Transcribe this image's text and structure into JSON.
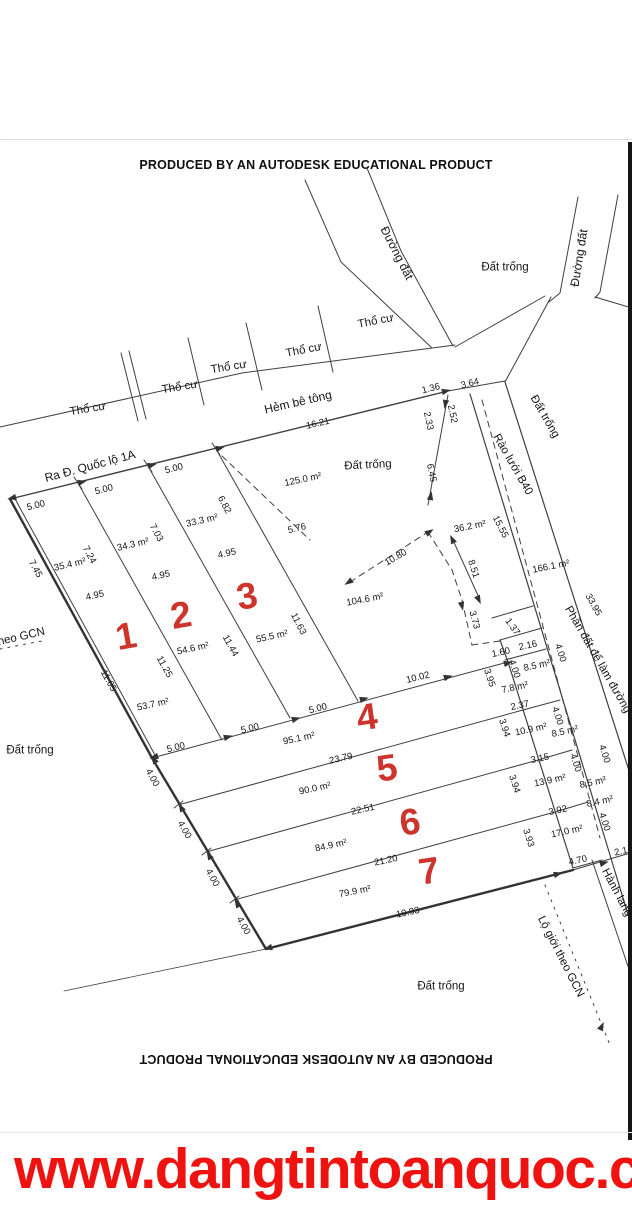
{
  "watermark": {
    "text": "PRODUCED BY AN AUTODESK EDUCATIONAL PRODUCT"
  },
  "footer": {
    "url": "www.dangtintoanquoc.co"
  },
  "colors": {
    "plot_number": "#c9251d",
    "url": "#ee1310",
    "line": "#3f3f3f"
  },
  "plots": [
    {
      "no": "1",
      "area": "53.7 m²"
    },
    {
      "no": "2",
      "area": "54.6 m²"
    },
    {
      "no": "3",
      "area": "55.5 m²"
    },
    {
      "no": "4",
      "area": "95.1 m²"
    },
    {
      "no": "5",
      "area": "90.0 m²"
    },
    {
      "no": "6",
      "area": "84.9 m²"
    },
    {
      "no": "7",
      "area": "79.9 m²"
    }
  ],
  "map": {
    "labels": [
      {
        "t": "Đường đất",
        "x": 397,
        "y": 253,
        "r": 63,
        "c": "r"
      },
      {
        "t": "Đường đất",
        "x": 579,
        "y": 258,
        "r": -81,
        "c": "r"
      },
      {
        "t": "Đất trống",
        "x": 505,
        "y": 268,
        "r": 0,
        "c": "p"
      },
      {
        "t": "Thổ cư",
        "x": 88,
        "y": 410,
        "r": -9,
        "c": "p"
      },
      {
        "t": "Thổ cư",
        "x": 180,
        "y": 388,
        "r": -9,
        "c": "p"
      },
      {
        "t": "Thổ cư",
        "x": 229,
        "y": 368,
        "r": -9,
        "c": "p"
      },
      {
        "t": "Thổ cư",
        "x": 304,
        "y": 351,
        "r": -11,
        "c": "p"
      },
      {
        "t": "Thổ cư",
        "x": 376,
        "y": 322,
        "r": -11,
        "c": "p"
      },
      {
        "t": "Hẻm bê tông",
        "x": 298,
        "y": 402,
        "r": -13,
        "c": "r"
      },
      {
        "t": "Ra Đ. Quốc lộ 1A",
        "x": 90,
        "y": 466,
        "r": -15,
        "c": "r"
      },
      {
        "t": "Đất trống",
        "x": 368,
        "y": 466,
        "r": -3,
        "c": "p"
      },
      {
        "t": "Đất trống",
        "x": 544,
        "y": 417,
        "r": 60,
        "c": "p"
      },
      {
        "t": "Rào lưới B40",
        "x": 512,
        "y": 465,
        "r": 60,
        "c": "p"
      },
      {
        "t": "Phần đất để làm đường",
        "x": 597,
        "y": 660,
        "r": 60,
        "c": "p"
      },
      {
        "t": "Hành lang",
        "x": 616,
        "y": 893,
        "r": 62,
        "c": "p"
      },
      {
        "t": "Lộ giới theo GCN",
        "x": 560,
        "y": 957,
        "r": 63,
        "c": "p"
      },
      {
        "t": "theo GCN",
        "x": 20,
        "y": 638,
        "r": -13,
        "c": "p"
      },
      {
        "t": "Đất trống",
        "x": 30,
        "y": 751,
        "r": 0,
        "c": "p"
      },
      {
        "t": "Đất trống",
        "x": 441,
        "y": 987,
        "r": 0,
        "c": "p"
      },
      {
        "t": "16.21",
        "x": 318,
        "y": 424,
        "r": -13,
        "c": "d"
      },
      {
        "t": "1.36",
        "x": 431,
        "y": 389,
        "r": -14,
        "c": "d"
      },
      {
        "t": "3.64",
        "x": 470,
        "y": 384,
        "r": -14,
        "c": "d"
      },
      {
        "t": "2.33",
        "x": 428,
        "y": 421,
        "r": 78,
        "c": "d"
      },
      {
        "t": "2.52",
        "x": 452,
        "y": 414,
        "r": 78,
        "c": "d"
      },
      {
        "t": "6.45",
        "x": 431,
        "y": 473,
        "r": 78,
        "c": "d"
      },
      {
        "t": "5.00",
        "x": 36,
        "y": 506,
        "r": -14,
        "c": "d"
      },
      {
        "t": "5.00",
        "x": 104,
        "y": 490,
        "r": -14,
        "c": "d"
      },
      {
        "t": "5.00",
        "x": 174,
        "y": 469,
        "r": -14,
        "c": "d"
      },
      {
        "t": "7.45",
        "x": 35,
        "y": 569,
        "r": 62,
        "c": "d"
      },
      {
        "t": "7.24",
        "x": 89,
        "y": 555,
        "r": 62,
        "c": "d"
      },
      {
        "t": "7.03",
        "x": 156,
        "y": 533,
        "r": 62,
        "c": "d"
      },
      {
        "t": "6.82",
        "x": 224,
        "y": 505,
        "r": 62,
        "c": "d"
      },
      {
        "t": "4.95",
        "x": 95,
        "y": 596,
        "r": -13,
        "c": "d"
      },
      {
        "t": "4.95",
        "x": 161,
        "y": 576,
        "r": -13,
        "c": "d"
      },
      {
        "t": "4.95",
        "x": 227,
        "y": 554,
        "r": -13,
        "c": "d"
      },
      {
        "t": "5.76",
        "x": 297,
        "y": 529,
        "r": -13,
        "c": "d"
      },
      {
        "t": "10.80",
        "x": 396,
        "y": 558,
        "r": -30,
        "c": "d"
      },
      {
        "t": "11.05",
        "x": 108,
        "y": 681,
        "r": 61,
        "c": "d"
      },
      {
        "t": "11.25",
        "x": 164,
        "y": 667,
        "r": 61,
        "c": "d"
      },
      {
        "t": "11.44",
        "x": 230,
        "y": 646,
        "r": 61,
        "c": "d"
      },
      {
        "t": "11.63",
        "x": 298,
        "y": 624,
        "r": 63,
        "c": "d"
      },
      {
        "t": "5.00",
        "x": 176,
        "y": 748,
        "r": -14,
        "c": "d"
      },
      {
        "t": "5.00",
        "x": 250,
        "y": 729,
        "r": -14,
        "c": "d"
      },
      {
        "t": "5.00",
        "x": 318,
        "y": 709,
        "r": -14,
        "c": "d"
      },
      {
        "t": "10.02",
        "x": 418,
        "y": 678,
        "r": -14,
        "c": "d"
      },
      {
        "t": "23.79",
        "x": 341,
        "y": 759,
        "r": -13,
        "c": "d"
      },
      {
        "t": "22.51",
        "x": 363,
        "y": 810,
        "r": -13,
        "c": "d"
      },
      {
        "t": "21.20",
        "x": 386,
        "y": 861,
        "r": -12,
        "c": "d"
      },
      {
        "t": "19.93",
        "x": 408,
        "y": 913,
        "r": -12,
        "c": "d"
      },
      {
        "t": "4.00",
        "x": 152,
        "y": 778,
        "r": 61,
        "c": "d"
      },
      {
        "t": "4.00",
        "x": 184,
        "y": 830,
        "r": 61,
        "c": "d"
      },
      {
        "t": "4.00",
        "x": 212,
        "y": 878,
        "r": 61,
        "c": "d"
      },
      {
        "t": "4.00",
        "x": 243,
        "y": 926,
        "r": 61,
        "c": "d"
      },
      {
        "t": "8.51",
        "x": 473,
        "y": 569,
        "r": 72,
        "c": "d"
      },
      {
        "t": "15.55",
        "x": 500,
        "y": 527,
        "r": 63,
        "c": "d"
      },
      {
        "t": "33.95",
        "x": 593,
        "y": 605,
        "r": 61,
        "c": "d"
      },
      {
        "t": "3.73",
        "x": 474,
        "y": 620,
        "r": 75,
        "c": "d"
      },
      {
        "t": "1.37",
        "x": 512,
        "y": 627,
        "r": 55,
        "c": "d"
      },
      {
        "t": "1.60",
        "x": 501,
        "y": 653,
        "r": -12,
        "c": "d"
      },
      {
        "t": "2.16",
        "x": 528,
        "y": 646,
        "r": -12,
        "c": "d"
      },
      {
        "t": "3.95",
        "x": 489,
        "y": 678,
        "r": 72,
        "c": "d"
      },
      {
        "t": "4.00",
        "x": 514,
        "y": 669,
        "r": 72,
        "c": "d"
      },
      {
        "t": "4.00",
        "x": 560,
        "y": 653,
        "r": 72,
        "c": "d"
      },
      {
        "t": "2.37",
        "x": 520,
        "y": 706,
        "r": -12,
        "c": "d"
      },
      {
        "t": "4.00",
        "x": 557,
        "y": 716,
        "r": 72,
        "c": "d"
      },
      {
        "t": "3.94",
        "x": 504,
        "y": 728,
        "r": 72,
        "c": "d"
      },
      {
        "t": "3.15",
        "x": 540,
        "y": 759,
        "r": -12,
        "c": "d"
      },
      {
        "t": "4.00",
        "x": 575,
        "y": 763,
        "r": 72,
        "c": "d"
      },
      {
        "t": "4.00",
        "x": 604,
        "y": 754,
        "r": 72,
        "c": "d"
      },
      {
        "t": "3.94",
        "x": 514,
        "y": 784,
        "r": 72,
        "c": "d"
      },
      {
        "t": "3.92",
        "x": 558,
        "y": 811,
        "r": -12,
        "c": "d"
      },
      {
        "t": "3.93",
        "x": 528,
        "y": 838,
        "r": 72,
        "c": "d"
      },
      {
        "t": "4.00",
        "x": 604,
        "y": 822,
        "r": 72,
        "c": "d"
      },
      {
        "t": "2.1",
        "x": 621,
        "y": 852,
        "r": -12,
        "c": "d"
      },
      {
        "t": "4.70",
        "x": 578,
        "y": 861,
        "r": -12,
        "c": "d"
      },
      {
        "t": "125.0 m²",
        "x": 303,
        "y": 480,
        "r": -12,
        "c": "a"
      },
      {
        "t": "35.4 m²",
        "x": 70,
        "y": 565,
        "r": -13,
        "c": "a"
      },
      {
        "t": "34.3 m²",
        "x": 133,
        "y": 545,
        "r": -13,
        "c": "a"
      },
      {
        "t": "33.3 m²",
        "x": 202,
        "y": 521,
        "r": -13,
        "c": "a"
      },
      {
        "t": "104.6 m²",
        "x": 365,
        "y": 600,
        "r": -11,
        "c": "a"
      },
      {
        "t": "36.2 m²",
        "x": 470,
        "y": 527,
        "r": -11,
        "c": "a"
      },
      {
        "t": "166.1 m²",
        "x": 551,
        "y": 567,
        "r": -11,
        "c": "a"
      },
      {
        "t": "54.6 m²",
        "x": 193,
        "y": 649,
        "r": -12,
        "c": "a"
      },
      {
        "t": "55.5 m²",
        "x": 272,
        "y": 637,
        "r": -12,
        "c": "a"
      },
      {
        "t": "53.7 m²",
        "x": 153,
        "y": 705,
        "r": -12,
        "c": "a"
      },
      {
        "t": "95.1 m²",
        "x": 299,
        "y": 739,
        "r": -12,
        "c": "a"
      },
      {
        "t": "90.0 m²",
        "x": 315,
        "y": 789,
        "r": -12,
        "c": "a"
      },
      {
        "t": "84.9 m²",
        "x": 331,
        "y": 846,
        "r": -12,
        "c": "a"
      },
      {
        "t": "79.9 m²",
        "x": 355,
        "y": 892,
        "r": -11,
        "c": "a"
      },
      {
        "t": "8.5 m²",
        "x": 537,
        "y": 666,
        "r": -12,
        "c": "a"
      },
      {
        "t": "7.8 m²",
        "x": 515,
        "y": 688,
        "r": -12,
        "c": "a"
      },
      {
        "t": "10.9 m²",
        "x": 531,
        "y": 730,
        "r": -12,
        "c": "a"
      },
      {
        "t": "8.5 m²",
        "x": 565,
        "y": 732,
        "r": -12,
        "c": "a"
      },
      {
        "t": "13.9 m²",
        "x": 550,
        "y": 781,
        "r": -12,
        "c": "a"
      },
      {
        "t": "8.5 m²",
        "x": 593,
        "y": 783,
        "r": -12,
        "c": "a"
      },
      {
        "t": "17.0 m²",
        "x": 567,
        "y": 832,
        "r": -12,
        "c": "a"
      },
      {
        "t": "8.4 m²",
        "x": 600,
        "y": 802,
        "r": -12,
        "c": "a"
      },
      {
        "t": "1",
        "x": 126,
        "y": 636,
        "r": -10,
        "c": "n"
      },
      {
        "t": "2",
        "x": 181,
        "y": 615,
        "r": -10,
        "c": "n"
      },
      {
        "t": "3",
        "x": 247,
        "y": 596,
        "r": -10,
        "c": "n"
      },
      {
        "t": "4",
        "x": 367,
        "y": 717,
        "r": -8,
        "c": "n"
      },
      {
        "t": "5",
        "x": 387,
        "y": 768,
        "r": -8,
        "c": "n"
      },
      {
        "t": "6",
        "x": 410,
        "y": 822,
        "r": -8,
        "c": "n"
      },
      {
        "t": "7",
        "x": 429,
        "y": 871,
        "r": -8,
        "c": "n"
      }
    ]
  }
}
